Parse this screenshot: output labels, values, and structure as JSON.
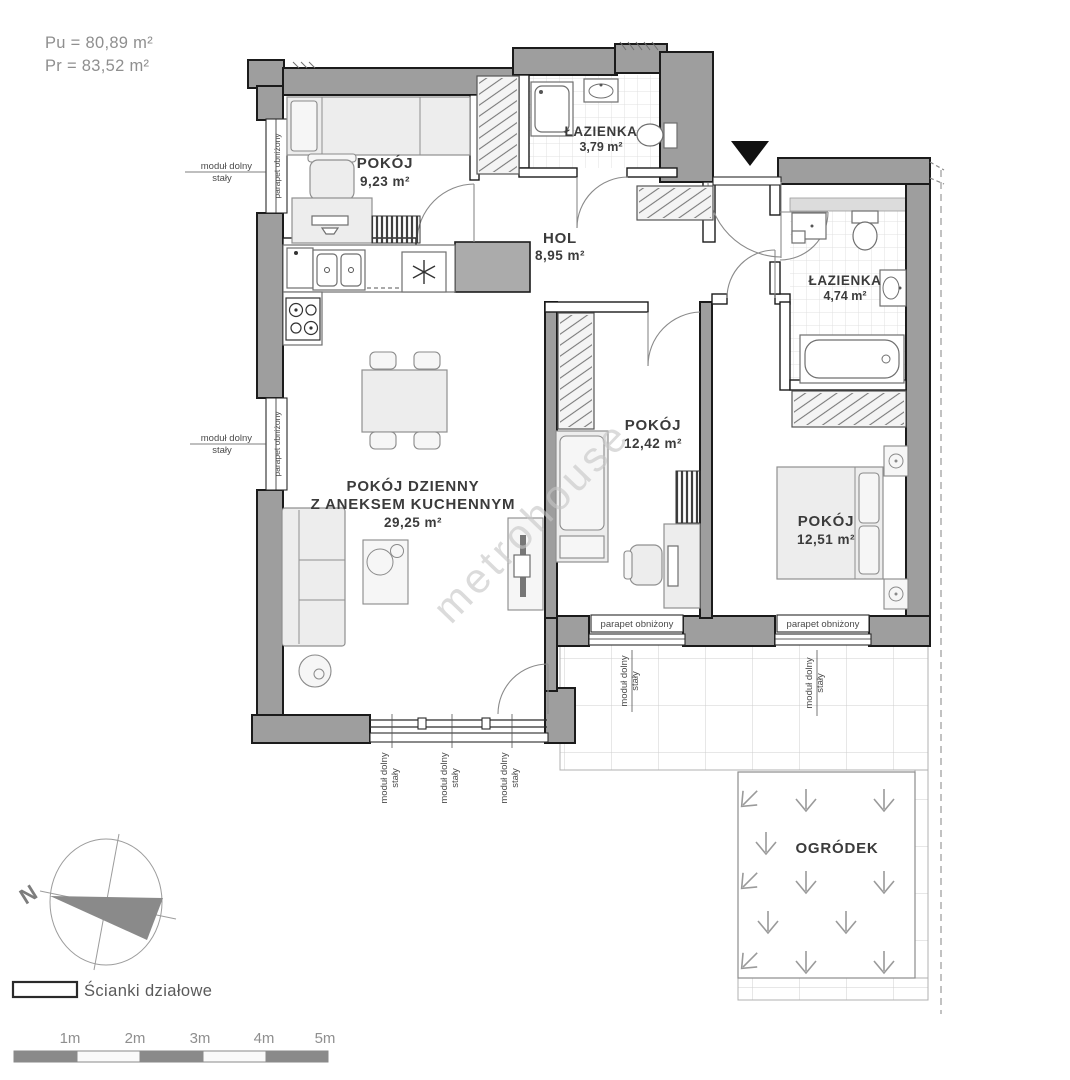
{
  "header": {
    "pu": "Pu = 80,89 m²",
    "pr": "Pr = 83,52 m²"
  },
  "rooms": {
    "pokoj1": {
      "name": "POKÓJ",
      "area": "9,23 m²"
    },
    "lazienka1": {
      "name": "ŁAZIENKA",
      "area": "3,79 m²"
    },
    "hol": {
      "name": "HOL",
      "area": "8,95 m²"
    },
    "lazienka2": {
      "name": "ŁAZIENKA",
      "area": "4,74 m²"
    },
    "pokoj2": {
      "name": "POKÓJ",
      "area": "12,42 m²"
    },
    "pokoj3": {
      "name": "POKÓJ",
      "area": "12,51 m²"
    },
    "salon": {
      "line1": "POKÓJ DZIENNY",
      "line2": "Z ANEKSEM KUCHENNYM",
      "area": "29,25 m²"
    },
    "ogrodek": {
      "name": "OGRÓDEK"
    }
  },
  "annotations": {
    "modul_line1": "moduł dolny",
    "modul_line2": "stały",
    "parapet": "parapet obniżony"
  },
  "watermark": "metrohouse",
  "compass": {
    "north": "N"
  },
  "legend": {
    "partition_label": "Ścianki działowe"
  },
  "scalebar": {
    "labels": [
      "1m",
      "2m",
      "3m",
      "4m",
      "5m"
    ]
  },
  "colors": {
    "wall": "#9e9e9e",
    "outline": "#1b1b1b",
    "text_gray": "#8f8f8f"
  }
}
